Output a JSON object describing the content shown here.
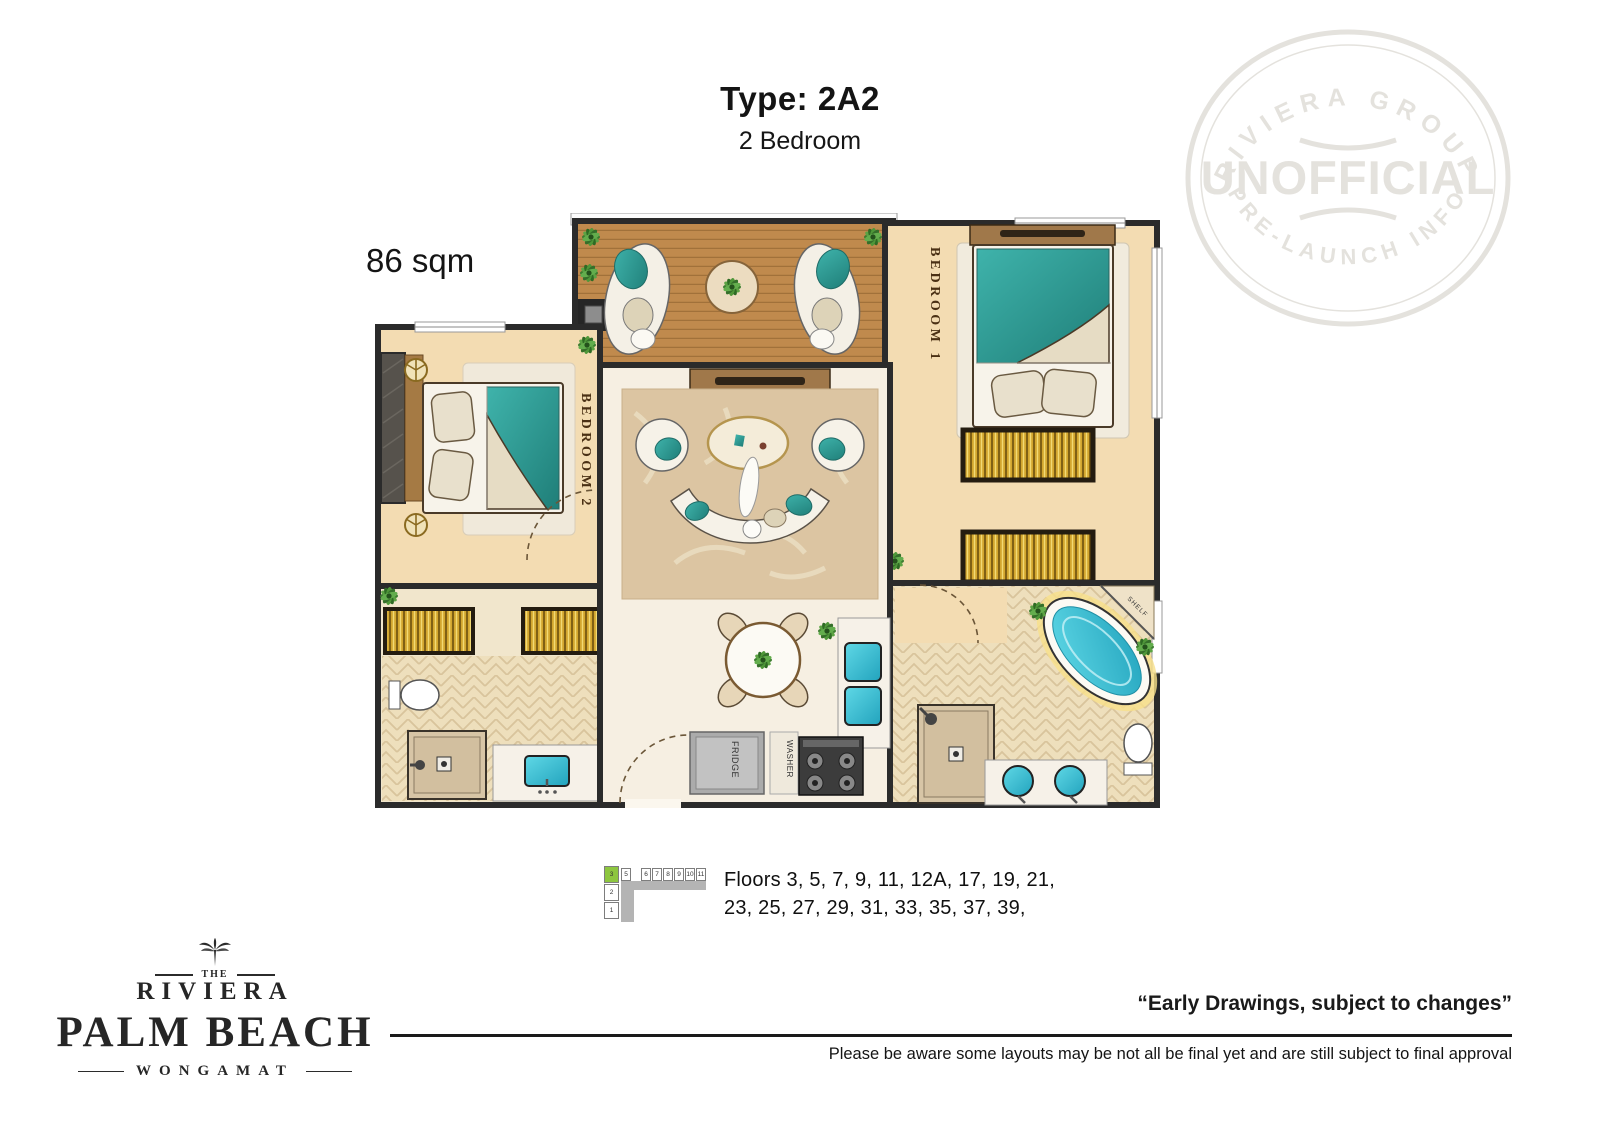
{
  "header": {
    "type_label": "Type: 2A2",
    "bedrooms": "2 Bedroom"
  },
  "area_label": "86 sqm",
  "watermark": {
    "arc_top": "RIVIERA GROUP",
    "center": "UNOFFICIAL",
    "arc_bottom": "PRE-LAUNCH INFO",
    "color": "#e4e2dd"
  },
  "plan_labels": {
    "bedroom1": "BEDROOM 1",
    "bedroom2": "BEDROOM 2",
    "fridge": "FRIDGE",
    "washer": "WASHER",
    "shelf": "SHELF"
  },
  "floor_indicator": {
    "highlighted_cell": "3",
    "row_cells": [
      "5",
      "6",
      "7",
      "8",
      "9",
      "10",
      "11"
    ],
    "column_cells": [
      "2",
      "1"
    ],
    "line1": "Floors 3, 5, 7, 9, 11, 12A, 17, 19, 21,",
    "line2": "23, 25, 27, 29, 31, 33, 35, 37, 39,",
    "highlight_color": "#8dc63f"
  },
  "logo": {
    "the": "THE",
    "riviera": "RIVIERA",
    "name": "PALM BEACH",
    "location": "WONGAMAT"
  },
  "footer": {
    "quote": "“Early Drawings, subject to changes”",
    "disclaimer": "Please be aware some layouts may be not all be final yet and are still subject to final approval"
  },
  "colors": {
    "wall": "#2b2b2b",
    "teal": "#35a9a2",
    "bath_water": "#39b9cf",
    "wood": "#c08a4d",
    "gold": "#d3a62e",
    "tan_floor": "#f3dcb2",
    "cream_floor": "#f6efe2",
    "green_accent": "#8dc63f"
  }
}
